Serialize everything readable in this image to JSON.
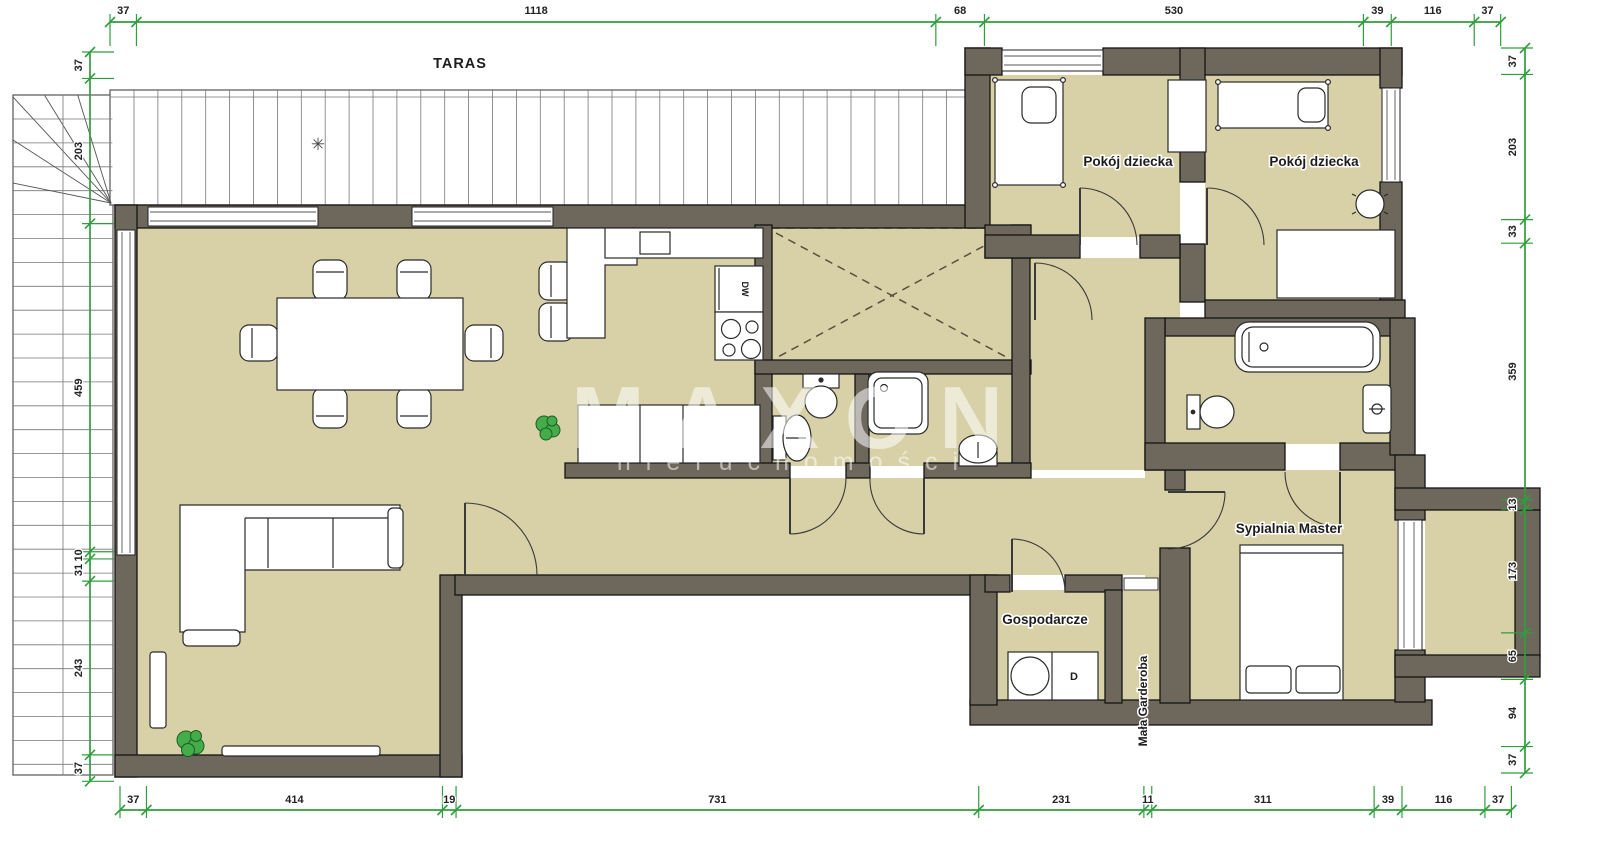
{
  "plan": {
    "terrace_label": "TARAS",
    "terrace_star": "✳",
    "rooms": [
      {
        "id": "pokoj-dziecka-1",
        "label": "Pokój dziecka"
      },
      {
        "id": "pokoj-dziecka-2",
        "label": "Pokój dziecka"
      },
      {
        "id": "sypialnia-master",
        "label": "Sypialnia Master"
      },
      {
        "id": "gospodarcze",
        "label": "Gospodarcze"
      },
      {
        "id": "mala-garderoba",
        "label": "Mała Garderoba"
      }
    ],
    "appliances": {
      "dishwasher": "DW",
      "dryer": "D"
    }
  },
  "watermark": {
    "primary": "MAXON",
    "secondary": "nieruchomości"
  },
  "dimensions": {
    "top": {
      "values": [
        "37",
        "1118",
        "68",
        "530",
        "39",
        "116",
        "37"
      ]
    },
    "bottom": {
      "values": [
        "37",
        "414",
        "19",
        "731",
        "231",
        "11",
        "311",
        "39",
        "116",
        "37"
      ]
    },
    "left": {
      "values": [
        "37",
        "203",
        "459",
        "10",
        "31",
        "243",
        "37"
      ]
    },
    "right": {
      "values": [
        "37",
        "203",
        "33",
        "359",
        "13",
        "173",
        "65",
        "94",
        "37"
      ]
    }
  },
  "colors": {
    "floor": "#d8d1a8",
    "wall": "#6e675c",
    "dimension_green": "#2f9e3c",
    "plant_green": "#44ad49",
    "watermark": "rgba(255,255,255,0.55)"
  }
}
